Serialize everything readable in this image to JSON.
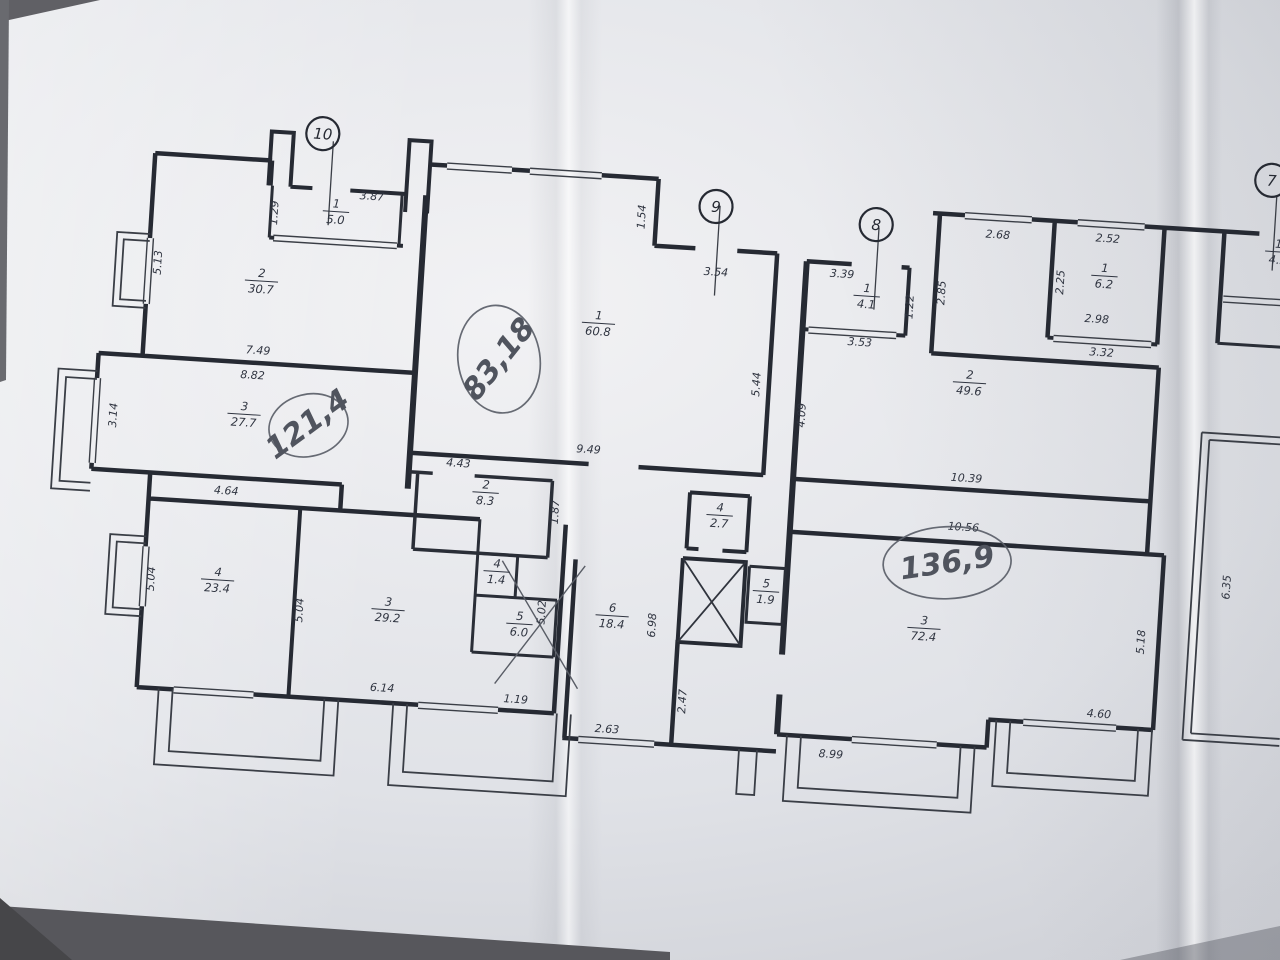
{
  "photo": {
    "background_color": "#5d5e63",
    "paper_color": "#e9ebf0",
    "ink_color": "#262a33",
    "pencil_color": "#50545e"
  },
  "plan": {
    "apartment_circles": [
      {
        "number": "10",
        "x": 299,
        "y": 57
      },
      {
        "number": "9",
        "x": 696,
        "y": 105
      },
      {
        "number": "8",
        "x": 857,
        "y": 113
      },
      {
        "number": "7",
        "x": 1249,
        "y": 44
      }
    ],
    "handwritten_notes": [
      {
        "text": "121,4",
        "x": 303,
        "y": 349,
        "rotation": -40,
        "font_size": 26,
        "ellipse_rx": 40,
        "ellipse_ry": 31,
        "ellipse_rotation": -18
      },
      {
        "text": "83,18",
        "x": 489,
        "y": 271,
        "rotation": -55,
        "font_size": 30,
        "ellipse_rx": 41,
        "ellipse_ry": 54,
        "ellipse_rotation": -12
      },
      {
        "text": "136,9",
        "x": 949,
        "y": 446,
        "rotation": -12,
        "font_size": 31,
        "ellipse_rx": 64,
        "ellipse_ry": 36,
        "ellipse_rotation": -6
      }
    ],
    "room_labels": [
      {
        "number": "1",
        "area": "5.0",
        "x": 317,
        "y": 133
      },
      {
        "number": "2",
        "area": "30.7",
        "x": 247,
        "y": 207
      },
      {
        "number": "3",
        "area": "27.7",
        "x": 238,
        "y": 341
      },
      {
        "number": "4",
        "area": "23.4",
        "x": 222,
        "y": 508
      },
      {
        "number": "3",
        "area": "29.2",
        "x": 394,
        "y": 527
      },
      {
        "number": "4",
        "area": "1.4",
        "x": 500,
        "y": 482
      },
      {
        "number": "5",
        "area": "6.0",
        "x": 526,
        "y": 533
      },
      {
        "number": "1",
        "area": "60.8",
        "x": 586,
        "y": 228
      },
      {
        "number": "2",
        "area": "8.3",
        "x": 484,
        "y": 404
      },
      {
        "number": "6",
        "area": "18.4",
        "x": 618,
        "y": 519
      },
      {
        "number": "4",
        "area": "2.7",
        "x": 719,
        "y": 412
      },
      {
        "number": "5",
        "area": "1.9",
        "x": 770,
        "y": 485
      },
      {
        "number": "1",
        "area": "4.1",
        "x": 852,
        "y": 184
      },
      {
        "number": "2",
        "area": "49.6",
        "x": 960,
        "y": 264
      },
      {
        "number": "1",
        "area": "6.2",
        "x": 1088,
        "y": 149
      },
      {
        "number": "3",
        "area": "72.4",
        "x": 930,
        "y": 512
      },
      {
        "number": "1",
        "area": "4.5",
        "x": 1260,
        "y": 114
      }
    ],
    "dimension_labels": [
      {
        "text": "3.87",
        "x": 352,
        "y": 120,
        "rotation": 0
      },
      {
        "text": "1.29",
        "x": 259,
        "y": 139,
        "rotation": -90
      },
      {
        "text": "5.13",
        "x": 146,
        "y": 196,
        "rotation": -90
      },
      {
        "text": "7.49",
        "x": 248,
        "y": 281,
        "rotation": 0
      },
      {
        "text": "8.82",
        "x": 244,
        "y": 306,
        "rotation": 0
      },
      {
        "text": "3.14",
        "x": 111,
        "y": 351,
        "rotation": -90
      },
      {
        "text": "4.64",
        "x": 225,
        "y": 423,
        "rotation": 0
      },
      {
        "text": "5.04",
        "x": 159,
        "y": 512,
        "rotation": -90
      },
      {
        "text": "5.04",
        "x": 309,
        "y": 534,
        "rotation": -90
      },
      {
        "text": "6.14",
        "x": 393,
        "y": 610,
        "rotation": 0
      },
      {
        "text": "1.19",
        "x": 527,
        "y": 613,
        "rotation": 0
      },
      {
        "text": "5.02",
        "x": 551,
        "y": 521,
        "rotation": -90
      },
      {
        "text": "4.43",
        "x": 455,
        "y": 381,
        "rotation": 0
      },
      {
        "text": "1.87",
        "x": 558,
        "y": 420,
        "rotation": -90
      },
      {
        "text": "9.49",
        "x": 584,
        "y": 359,
        "rotation": 0
      },
      {
        "text": "1.54",
        "x": 626,
        "y": 120,
        "rotation": -90
      },
      {
        "text": "3.54",
        "x": 700,
        "y": 174,
        "rotation": 0
      },
      {
        "text": "5.44",
        "x": 751,
        "y": 280,
        "rotation": -90
      },
      {
        "text": "4.09",
        "x": 798,
        "y": 308,
        "rotation": -90
      },
      {
        "text": "6.98",
        "x": 662,
        "y": 527,
        "rotation": -90
      },
      {
        "text": "2.63",
        "x": 620,
        "y": 637,
        "rotation": 0
      },
      {
        "text": "2.47",
        "x": 697,
        "y": 601,
        "rotation": -90
      },
      {
        "text": "3.39",
        "x": 826,
        "y": 168,
        "rotation": 0
      },
      {
        "text": "3.53",
        "x": 848,
        "y": 235,
        "rotation": 0
      },
      {
        "text": "1.22",
        "x": 899,
        "y": 193,
        "rotation": -90
      },
      {
        "text": "2.85",
        "x": 930,
        "y": 177,
        "rotation": -90
      },
      {
        "text": "2.68",
        "x": 979,
        "y": 119,
        "rotation": 0
      },
      {
        "text": "2.52",
        "x": 1089,
        "y": 116,
        "rotation": 0
      },
      {
        "text": "2.25",
        "x": 1048,
        "y": 159,
        "rotation": -90
      },
      {
        "text": "2.98",
        "x": 1083,
        "y": 197,
        "rotation": 0
      },
      {
        "text": "3.32",
        "x": 1090,
        "y": 230,
        "rotation": 0
      },
      {
        "text": "10.39",
        "x": 963,
        "y": 364,
        "rotation": 0
      },
      {
        "text": "10.56",
        "x": 963,
        "y": 413,
        "rotation": 0
      },
      {
        "text": "5.18",
        "x": 1151,
        "y": 513,
        "rotation": -90
      },
      {
        "text": "4.60",
        "x": 1110,
        "y": 591,
        "rotation": 0
      },
      {
        "text": "8.99",
        "x": 845,
        "y": 648,
        "rotation": 0
      },
      {
        "text": "6.35",
        "x": 1233,
        "y": 453,
        "rotation": -90
      }
    ]
  }
}
